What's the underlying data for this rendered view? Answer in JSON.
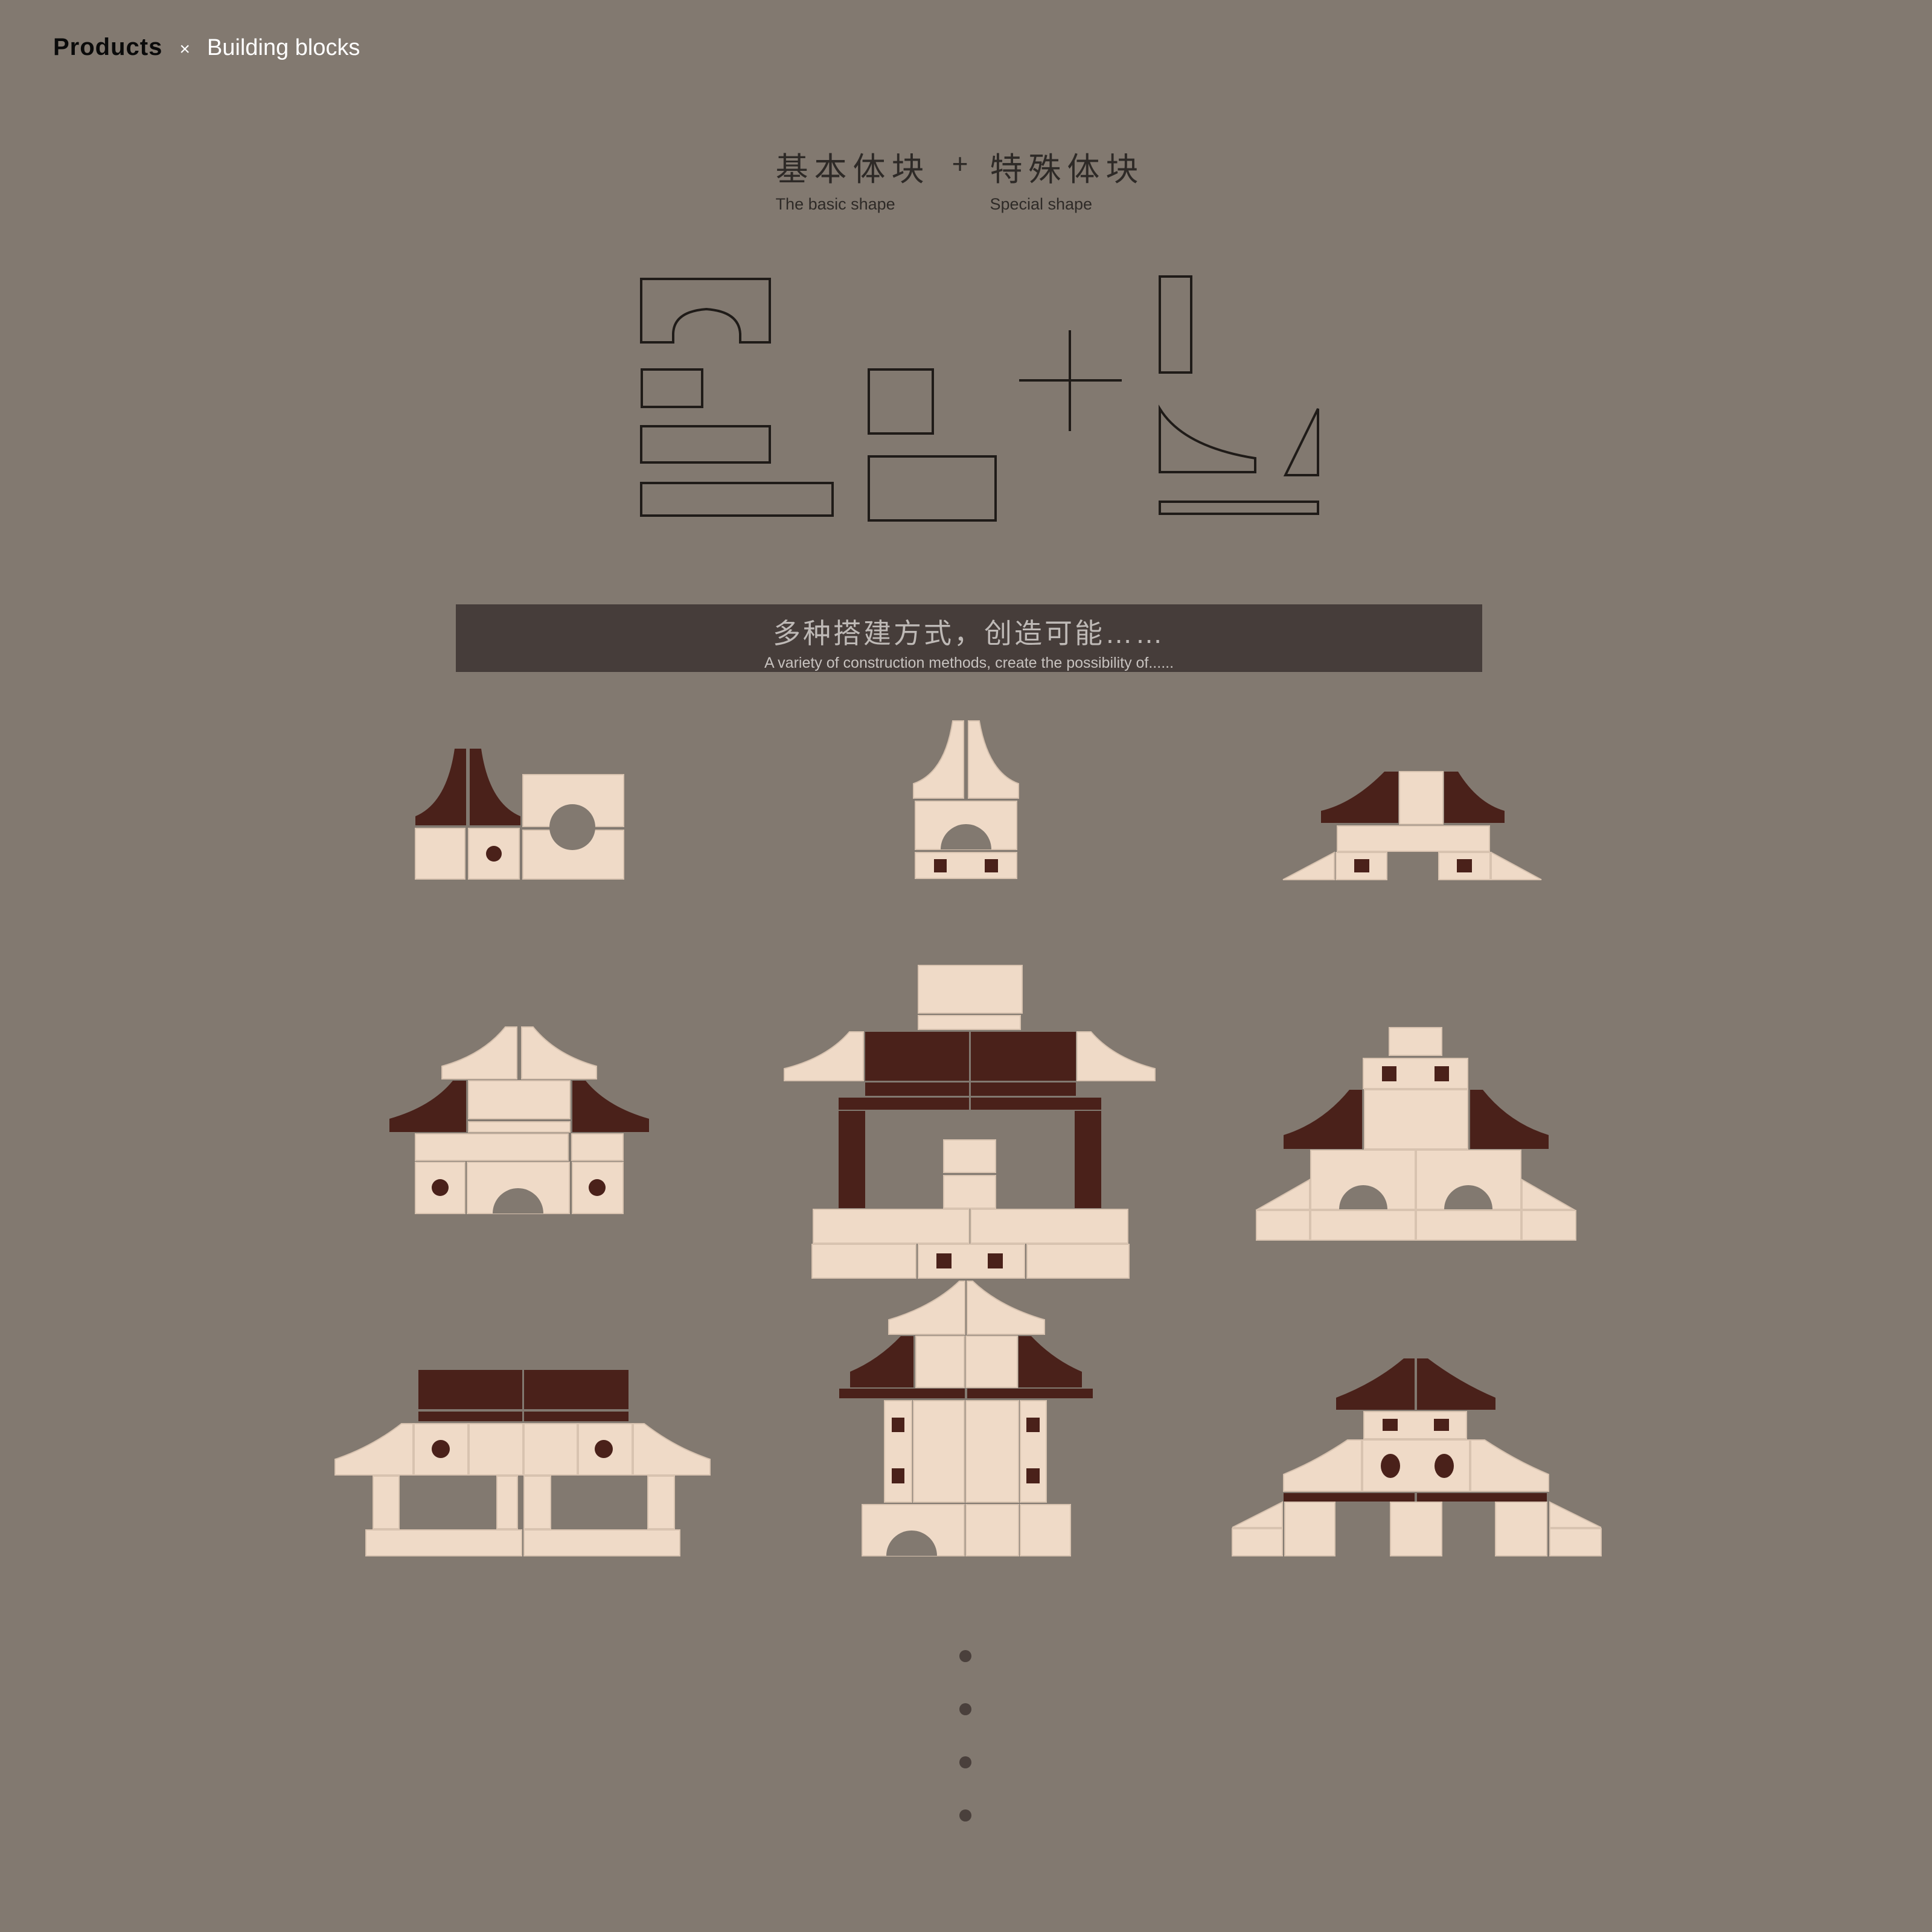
{
  "header": {
    "brand": "Products",
    "separator": "×",
    "category": "Building blocks"
  },
  "intro": {
    "left": {
      "cn": "基本体块",
      "en": "The basic shape"
    },
    "plus": "+",
    "right": {
      "cn": "特殊体块",
      "en": "Special shape"
    }
  },
  "banner": {
    "cn": "多种搭建方式，创造可能……",
    "en": "A variety of construction methods, create the possibility of......"
  },
  "shapes": {
    "basic": [
      "arch-block",
      "small-square",
      "rectangle",
      "long-rectangle",
      "square",
      "wide-rectangle"
    ],
    "operator": "+",
    "special": [
      "tall-column",
      "cove-wedge",
      "thin-triangle",
      "flat-plank"
    ]
  },
  "structures": [
    "bell-roof-house-with-round-window",
    "spire-arch-tower",
    "pavilion-with-triangle-feet",
    "two-tier-pagoda-with-arch",
    "grand-hall-on-pillars",
    "double-arch-hall",
    "long-pavilion-on-columns",
    "tall-gate-tower",
    "three-pillar-pavilion"
  ],
  "footer": {
    "ellipsis_dot_count": 4
  },
  "colors": {
    "bg": "#827970",
    "cream": "#EFDAC7",
    "cream_edge": "#D8C3B0",
    "maroon": "#4A211A",
    "banner_bg": "#463D3A",
    "banner_text": "#BEB9B6",
    "banner_subtext": "#C7C2BF",
    "ink": "#1F1B18",
    "ink_black": "#0A0A0A",
    "title": "#2E2A27",
    "white": "#FFFFFF",
    "dot": "#4A403C"
  }
}
